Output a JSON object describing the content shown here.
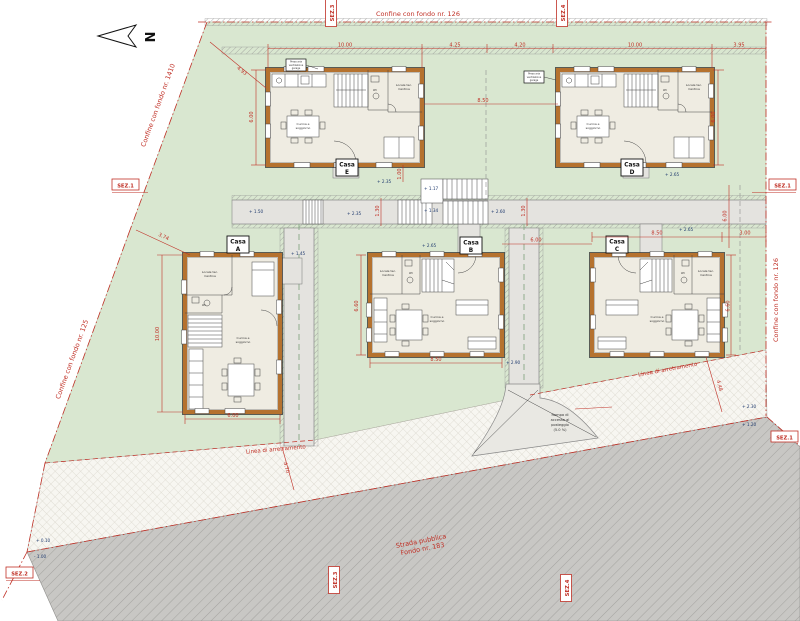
{
  "north": {
    "label": "N"
  },
  "boundaries": {
    "top": "Confine con fondo nr. 126",
    "left_upper": "Confine con fondo nr. 1410",
    "left_lower": "Confine con fondo nr. 125",
    "right": "Confine con fondo nr. 126",
    "setback_left": "Linea di arretramento",
    "setback_right": "Linea di arretramento",
    "road_line1": "Strada pubblica",
    "road_line2": "Fondo nr. 183"
  },
  "sections": {
    "sez1": "SEZ.1",
    "sez2": "SEZ.2",
    "sez3": "SEZ.3",
    "sez4": "SEZ.4"
  },
  "houses": {
    "a": {
      "l1": "Casa",
      "l2": "A"
    },
    "b": {
      "l1": "Casa",
      "l2": "B"
    },
    "c": {
      "l1": "Casa",
      "l2": "C"
    },
    "d": {
      "l1": "Casa",
      "l2": "D"
    },
    "e": {
      "l1": "Casa",
      "l2": "E"
    }
  },
  "rooms": {
    "tech1": "Locale tec.",
    "tech2": "Cantina",
    "living1": "Cucina e",
    "living2": "soggiorno",
    "wc": "WC"
  },
  "ramp": {
    "l1": "Rampa di",
    "l2": "accesso al",
    "l3": "posteggio",
    "l4": "(5.0 %)"
  },
  "note": {
    "l1": "Presa aria",
    "l2": "ventilazione",
    "l3": "garage"
  },
  "dims": {
    "top1": "10.00",
    "top2": "4.25",
    "top3": "4.20",
    "top4": "10.00",
    "top5": "3.95",
    "ed_gap": "8.50",
    "e_v": "6.00",
    "d_v": "6.00",
    "a_v": "10.00",
    "a_w": "6.00",
    "b_w": "8.50",
    "b_v": "6.60",
    "c_w": "8.50",
    "c_r": "3.00",
    "bc": "6.00",
    "c_v": "6.60",
    "r6": "6.00",
    "diag1": "4.93",
    "diag2": "3.74",
    "w1": "1.30",
    "w2": "1.30",
    "w3": "1.00",
    "side_r": "4.48",
    "side_l": "4.70"
  },
  "elevations": {
    "el1": "+ 2.35",
    "el2": "+ 1.17",
    "el3": "+ 1.34",
    "el4": "+ 2.60",
    "el5": "+ 2.35",
    "el6": "+ 1.50",
    "el7": "+ 1.45",
    "el8": "+ 2.65",
    "el9": "+ 2.65",
    "el10": "+ 2.65",
    "el11": "+ 2.90",
    "el12": "+ 2.30",
    "el13": "+ 1.20",
    "el14": "+ 0.10",
    "el15": "- 1.00"
  },
  "colors": {
    "site_green": "#d9e7d0",
    "road_gray": "#c8c7c4",
    "wall_orange": "#b5722f",
    "annotation_red": "#c03026",
    "floor_beige": "#efece2",
    "elevation_blue": "#1f3a6e"
  }
}
